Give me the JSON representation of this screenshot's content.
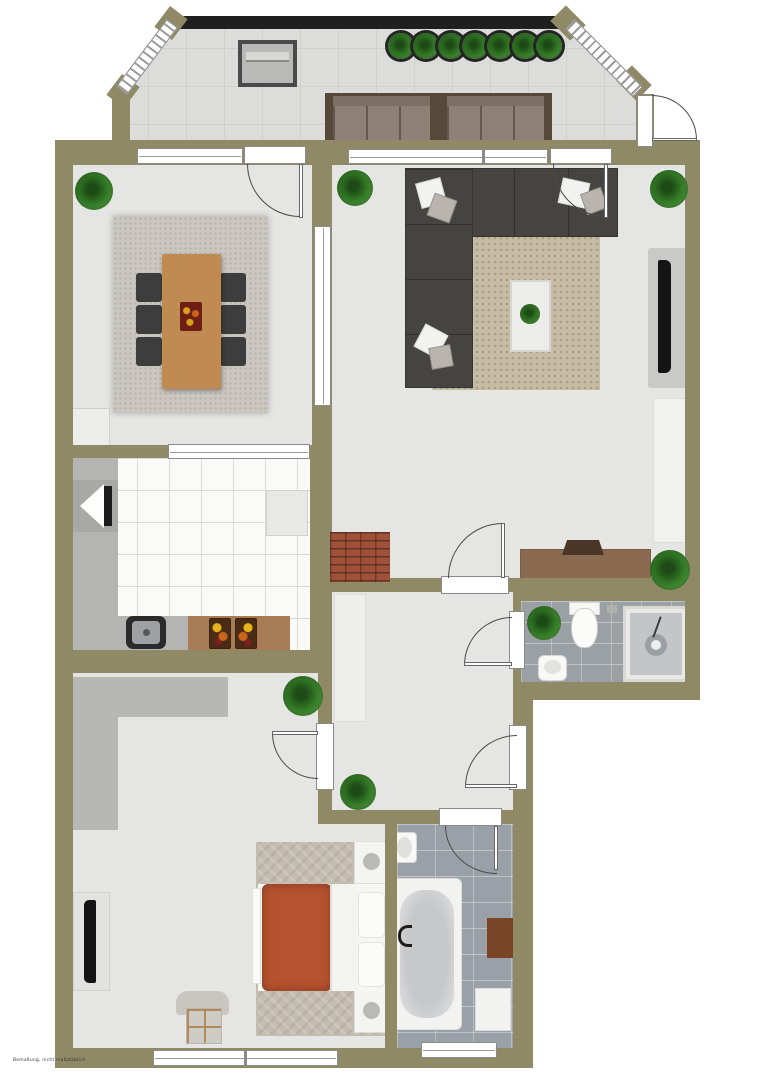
{
  "watermark": "Bemaßung, nicht maßstäblich",
  "palette": {
    "wall": "#8f8965",
    "floor": "#e5e5e3",
    "balcony_floor": "#dcdcda",
    "kitchen_tile": "#fafaf8",
    "counter": "#b4b4b2",
    "wood_counter": "#a87c54",
    "table_wood": "#c08b50",
    "chair": "#3d3d3d",
    "rug_dining": "#cbc7c0",
    "rug_living": "#c6bca4",
    "rug_bedroom": "#c4bdaf",
    "sofa": "#464441",
    "outdoor_cushion": "#8e8075",
    "outdoor_frame": "#57493a",
    "bed_duvet": "#b5522f",
    "brick": "#a0513a",
    "wc_tile": "#9ba0a4",
    "bath_tile": "#9aa0a8",
    "railing": "#1f1f1f",
    "tv": "#141414",
    "sideboard": "#8a6a50",
    "shelf": "#f1f1ef"
  },
  "plan": {
    "type": "floor-plan-top-view",
    "rooms": [
      {
        "name": "balcony",
        "furniture": [
          "railing",
          "storage-box",
          "planter-row-7",
          "outdoor-sofa",
          "balcony-side-door"
        ]
      },
      {
        "name": "dining-room",
        "furniture": [
          "rug",
          "dining-table",
          "chairs-6",
          "centerpiece",
          "cabinet",
          "plant"
        ]
      },
      {
        "name": "living-room",
        "furniture": [
          "corner-sofa",
          "pillows",
          "rug",
          "coffee-table",
          "wall-tv",
          "wall-shelf",
          "sideboard",
          "laptop",
          "brick-chimney",
          "plants-3"
        ]
      },
      {
        "name": "kitchen",
        "furniture": [
          "l-counter",
          "sink",
          "wood-counter",
          "cutting-boards-2",
          "fridge",
          "wall-appliance"
        ]
      },
      {
        "name": "hallway",
        "furniture": [
          "closet",
          "plant",
          "entrance-door"
        ]
      },
      {
        "name": "wc",
        "furniture": [
          "toilet",
          "hand-basin",
          "shower-cabin",
          "plant"
        ]
      },
      {
        "name": "bedroom",
        "furniture": [
          "bed",
          "nightstands-2",
          "lamps-2",
          "rug",
          "tv-panel",
          "armchair",
          "l-wardrobe",
          "plant"
        ]
      },
      {
        "name": "bathroom",
        "furniture": [
          "bathtub",
          "sink",
          "washing-machine",
          "mat"
        ]
      }
    ]
  }
}
